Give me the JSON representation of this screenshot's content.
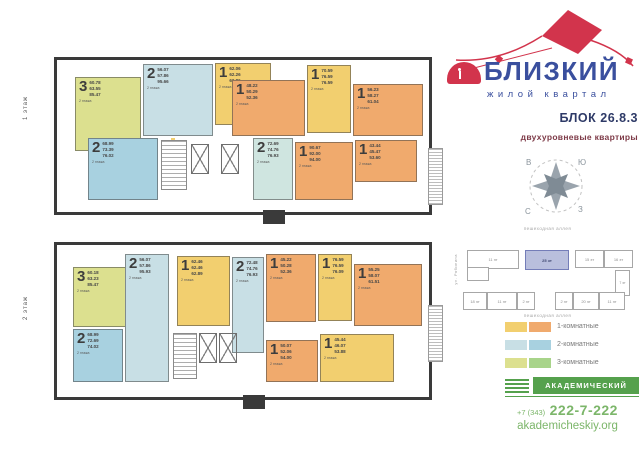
{
  "brand": {
    "name": "БЛИЗКИЙ",
    "tagline": "жилой квартал",
    "block": "БЛОК 26.8.3",
    "subtitle": "двухуровневые квартиры",
    "colors": {
      "blue": "#3a4f9e",
      "red": "#d2344c",
      "navy": "#2e3a67",
      "maroon": "#7d3a47"
    }
  },
  "floors": [
    {
      "label": "1 этаж",
      "units": [
        {
          "rooms": "3",
          "level_note": "2 этажа",
          "areas": "60.78\n63.55\n85.47",
          "type": "3-комнатная"
        },
        {
          "rooms": "2",
          "level_note": "2 этажа",
          "areas": "56.07\n57.86\n95.66",
          "type": "2-комнатная"
        },
        {
          "rooms": "1",
          "level_note": "2 этажа",
          "areas": "62.06\n62.26\n62.86",
          "type": "1-комнатная"
        },
        {
          "rooms": "1",
          "level_note": "2 этажа",
          "areas": "48.22\n50.29\n52.36",
          "type": "1-комнатная"
        },
        {
          "rooms": "1",
          "level_note": "2 этажа",
          "areas": "70.59\n76.59\n76.59",
          "type": "1-комнатная"
        },
        {
          "rooms": "1",
          "level_note": "2 этажа",
          "areas": "56.23\n58.27\n61.04",
          "type": "1-комнатная"
        },
        {
          "rooms": "2",
          "level_note": "2 этажа",
          "areas": "68.99\n73.39\n76.02",
          "type": "2-комнатная"
        },
        {
          "rooms": "2",
          "level_note": "2 этажа",
          "areas": "72.69\n74.76\n76.93",
          "type": "2-комнатная"
        },
        {
          "rooms": "1",
          "level_note": "2 этажа",
          "areas": "90.67\n92.00\n94.00",
          "type": "1-комнатная"
        },
        {
          "rooms": "1",
          "level_note": "2 этажа",
          "areas": "43.44\n45.47\n53.60",
          "type": "1-комнатная"
        }
      ]
    },
    {
      "label": "2 этаж",
      "units": [
        {
          "rooms": "3",
          "level_note": "2 этажа",
          "areas": "60.18\n63.23\n85.47",
          "type": "3-комнатная"
        },
        {
          "rooms": "2",
          "level_note": "2 этажа",
          "areas": "56.07\n57.86\n95.93",
          "type": "2-комнатная"
        },
        {
          "rooms": "1",
          "level_note": "2 этажа",
          "areas": "62.46\n62.46\n62.89",
          "type": "1-комнатная"
        },
        {
          "rooms": "2",
          "level_note": "2 этажа",
          "areas": "72.48\n74.76\n76.93",
          "type": "2-комнатная"
        },
        {
          "rooms": "1",
          "level_note": "2 этажа",
          "areas": "45.22\n50.28\n52.36",
          "type": "1-комнатная"
        },
        {
          "rooms": "1",
          "level_note": "2 этажа",
          "areas": "76.59\n76.59\n76.09",
          "type": "1-комнатная"
        },
        {
          "rooms": "1",
          "level_note": "2 этажа",
          "areas": "55.25\n58.07\n61.51",
          "type": "1-комнатная"
        },
        {
          "rooms": "2",
          "level_note": "2 этажа",
          "areas": "68.99\n72.69\n74.02",
          "type": "2-комнатная"
        },
        {
          "rooms": "1",
          "level_note": "2 этажа",
          "areas": "50.07\n52.06\n54.00",
          "type": "1-комнатная"
        },
        {
          "rooms": "1",
          "level_note": "2 этажа",
          "areas": "45.44\n46.07\n53.88",
          "type": "1-комнатная"
        }
      ]
    }
  ],
  "compass": {
    "tl": "В",
    "tr": "Ю",
    "bl": "С",
    "br": "З"
  },
  "site": {
    "alley_top": "пешеходная аллея",
    "alley_bottom": "пешеходная аллея",
    "street_left": "ул. Рябинина",
    "street_right": "ул. Шаманова",
    "highlight": {
      "label": "25 эт",
      "color": "#b9bfdd"
    },
    "buildings": [
      "11 эт",
      "15 эт",
      "16 эт",
      "7 эт",
      "18 эт",
      "11 эт",
      "2 эт",
      "2 эт",
      "20 эт",
      "11 эт"
    ]
  },
  "legend": {
    "items": [
      {
        "label": "1-комнатные",
        "colors": [
          "#f2cf6f",
          "#f0aa6d"
        ]
      },
      {
        "label": "2-комнатные",
        "colors": [
          "#c8dfe5",
          "#a8d1e0"
        ]
      },
      {
        "label": "3-комнатные",
        "colors": [
          "#dce08f",
          "#a8d48a"
        ]
      }
    ]
  },
  "footer": {
    "developer": "АКАДЕМИЧЕСКИЙ",
    "phone_prefix": "+7 (343)",
    "phone_number": "222-7-222",
    "site": "akademicheskiy.org",
    "green": "#55a14d",
    "light_green": "#7cb66a"
  }
}
